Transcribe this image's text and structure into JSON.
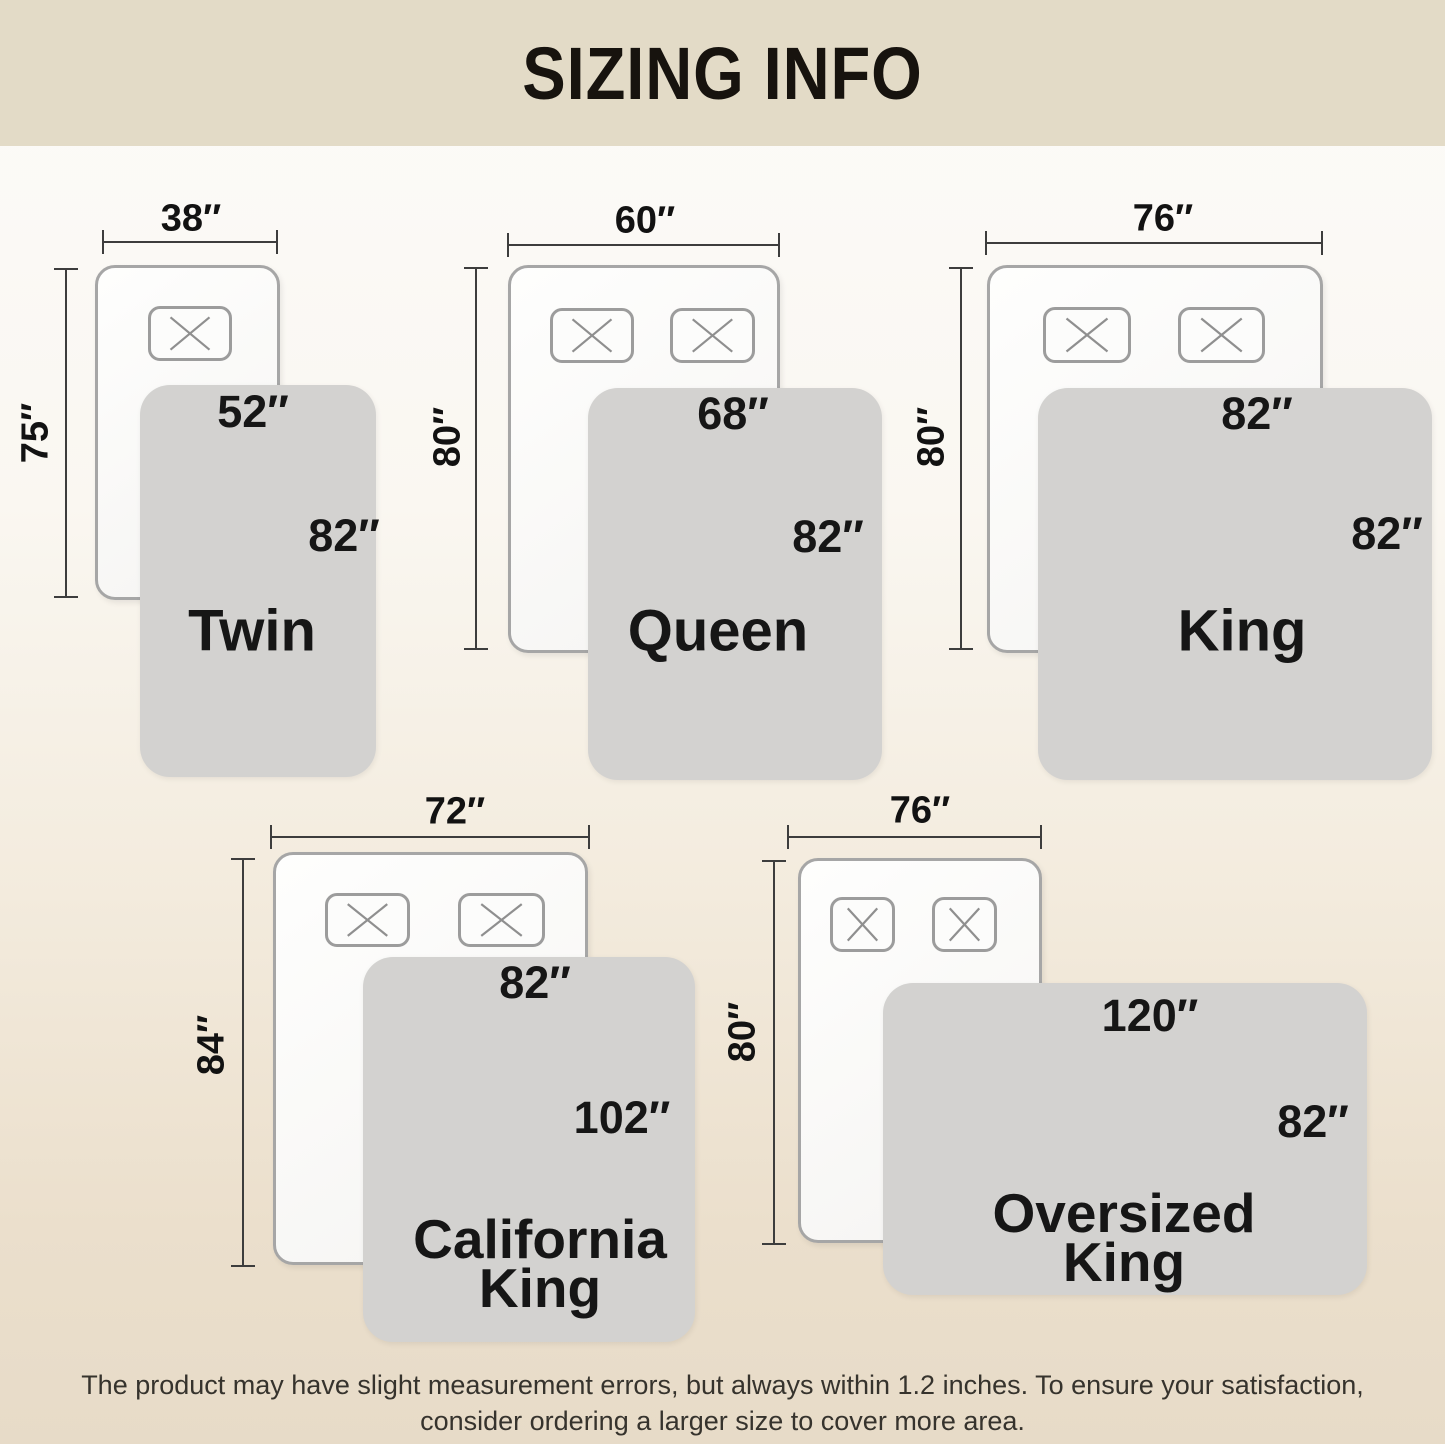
{
  "header": {
    "title": "SIZING INFO"
  },
  "sizes": [
    {
      "name": "Twin",
      "bed_width": "38″",
      "bed_length": "75″",
      "blanket_width": "52″",
      "blanket_length": "82″",
      "pillows": 1
    },
    {
      "name": "Queen",
      "bed_width": "60″",
      "bed_length": "80″",
      "blanket_width": "68″",
      "blanket_length": "82″",
      "pillows": 2
    },
    {
      "name": "King",
      "bed_width": "76″",
      "bed_length": "80″",
      "blanket_width": "82″",
      "blanket_length": "82″",
      "pillows": 2
    },
    {
      "name": "California King",
      "bed_width": "72″",
      "bed_length": "84″",
      "blanket_width": "82″",
      "blanket_length": "102″",
      "pillows": 2
    },
    {
      "name": "Oversized King",
      "bed_width": "76″",
      "bed_length": "80″",
      "blanket_width": "120″",
      "blanket_length": "82″",
      "pillows": 2
    }
  ],
  "footer": {
    "note": "The product may have slight measurement errors, but always within 1.2 inches. To ensure your satisfaction, consider ordering a larger size to cover more area."
  },
  "colors": {
    "header_band": "#e3dbc7",
    "background_top": "#fcfbf9",
    "background_bottom": "#e7dbc8",
    "bed_fill": "#fbfbfa",
    "bed_border": "#a6a6a6",
    "blanket_fill": "#d3d2d0",
    "dimension_line": "#3d3d3d",
    "text": "#151515"
  }
}
